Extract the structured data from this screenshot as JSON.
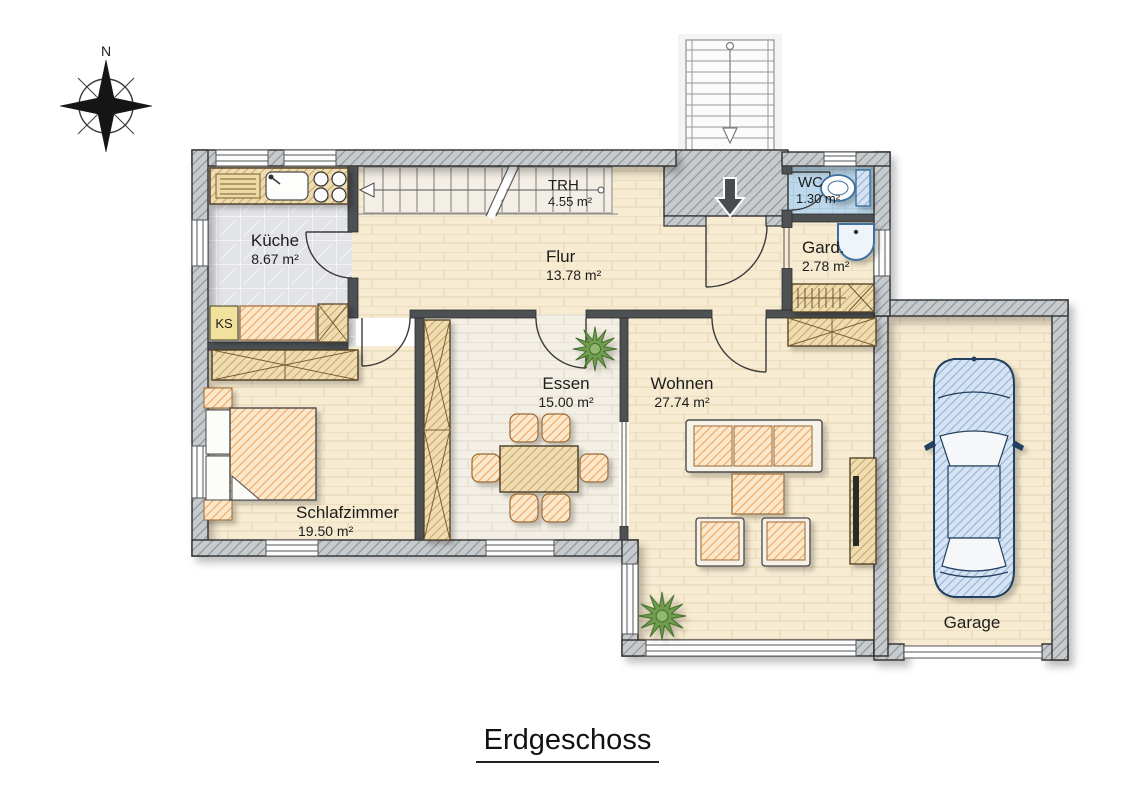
{
  "page": {
    "title": "Erdgeschoss"
  },
  "compass": {
    "north_label": "N"
  },
  "rooms": [
    {
      "name": "Küche",
      "area": "8.67 m²"
    },
    {
      "name": "TRH",
      "area": "4.55 m²"
    },
    {
      "name": "Flur",
      "area": "13.78 m²"
    },
    {
      "name": "WC",
      "area": "1.30 m²"
    },
    {
      "name": "Gard.",
      "area": "2.78 m²"
    },
    {
      "name": "Essen",
      "area": "15.00 m²"
    },
    {
      "name": "Wohnen",
      "area": "27.74 m²"
    },
    {
      "name": "Schlafzimmer",
      "area": "19.50 m²"
    },
    {
      "name": "Garage",
      "area": ""
    }
  ],
  "fixtures": {
    "fridge_label": "KS"
  },
  "colors": {
    "wall_gray": "#c7cbce",
    "furniture_orange": "#efa763",
    "wood_tan": "#cda55f",
    "sanitary_blue": "#92b4d8",
    "plant_green": "#6f9e4e",
    "floor_cream": "#f7ebd2",
    "essen_floor": "#f3efe5",
    "wc_tile_blue": "#bdd8ea"
  }
}
